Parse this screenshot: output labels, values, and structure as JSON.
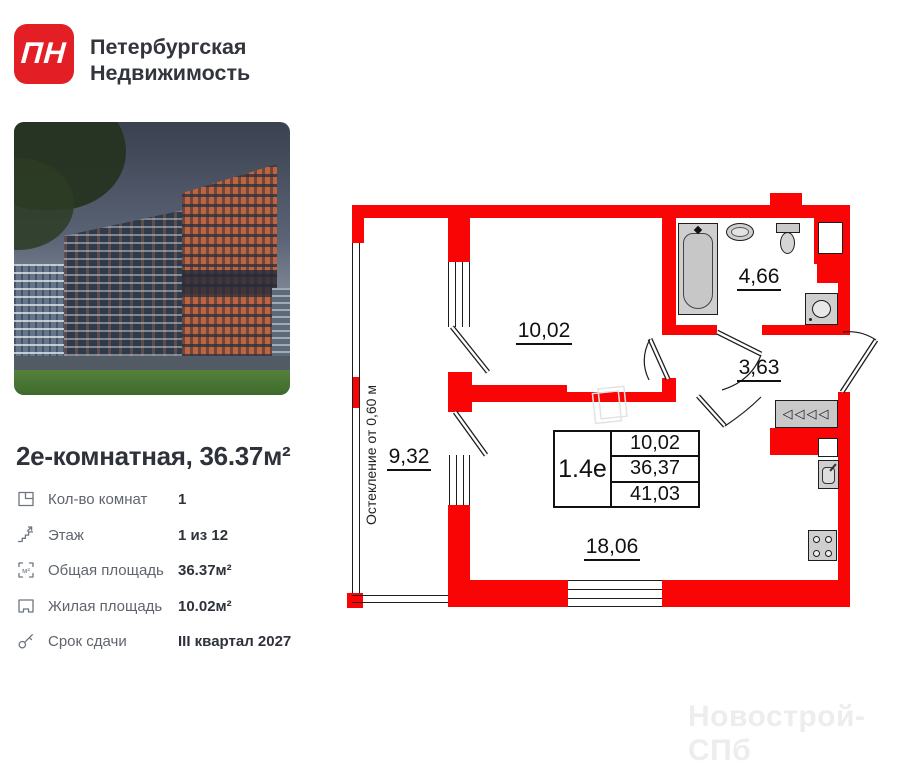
{
  "brand": {
    "logo_text": "ПН",
    "name_line1": "Петербургская",
    "name_line2": "Недвижимость"
  },
  "listing": {
    "title": "2е-комнатная, 36.37м²",
    "details": [
      {
        "icon": "floorplan-icon",
        "label": "Кол-во комнат",
        "value": "1"
      },
      {
        "icon": "stairs-icon",
        "label": "Этаж",
        "value": "1 из 12"
      },
      {
        "icon": "area-icon",
        "label": "Общая площадь",
        "value": "36.37м²"
      },
      {
        "icon": "living-area-icon",
        "label": "Жилая площадь",
        "value": "10.02м²"
      },
      {
        "icon": "key-icon",
        "label": "Срок сдачи",
        "value": "III квартал 2027"
      }
    ]
  },
  "floorplan": {
    "unit_label": "1.4е",
    "info_values": [
      "10,02",
      "36,37",
      "41,03"
    ],
    "rooms": [
      {
        "name": "living-room",
        "area": "10,02"
      },
      {
        "name": "bathroom",
        "area": "4,66"
      },
      {
        "name": "hallway",
        "area": "3,63"
      },
      {
        "name": "balcony",
        "area": "9,32"
      },
      {
        "name": "kitchen-living",
        "area": "18,06"
      }
    ],
    "glazing_note": "Остекление от 0,60 м",
    "wardrobe_glyphs": "◁◁◁◁",
    "fixtures": [
      "bathtub",
      "bath-sink",
      "toilet",
      "washing-machine",
      "wardrobe",
      "kitchen-sink",
      "stove"
    ],
    "watermark": "Новострой-СПб"
  },
  "colors": {
    "wall_red": "#f90505",
    "logo_red": "#e31e24"
  }
}
